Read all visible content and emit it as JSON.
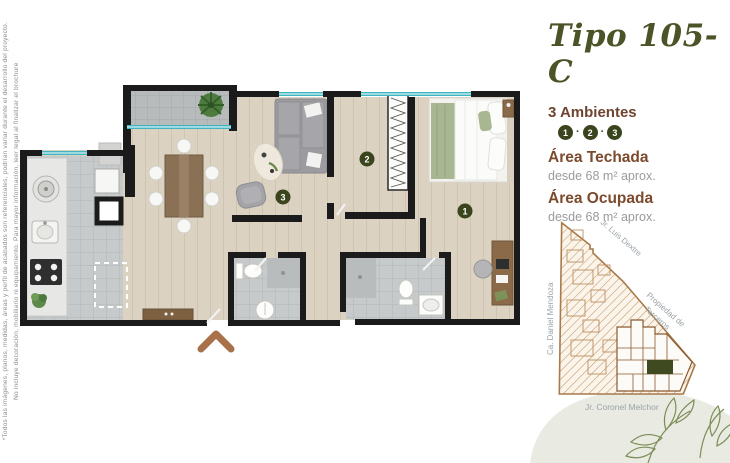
{
  "colors": {
    "title_green": "#4a5427",
    "ambientes_brown": "#6f4430",
    "area_brown": "#7c4a2d",
    "muted_gray": "#9b9b9b",
    "marker_olive": "#3b451d",
    "window_teal": "#3fb5c2",
    "map_brown": "#a87a4a",
    "unit_green": "#3f4a20",
    "chevron_brown": "#a9714a"
  },
  "disclaimer": {
    "line1": "*Todos las imágenes, planos, medidas, áreas y perfil de acabados son referenciales, podrían variar durante el desarrollo del proyecto.",
    "line2": "No incluye decoración, mobiliario ni equipamiento. Para mayor información, leer legal al finalizar el brochure"
  },
  "panel": {
    "title": "Tipo 105-C",
    "ambientes_label": "3 Ambientes",
    "separator": "·",
    "ambientes": [
      "1",
      "2",
      "3"
    ],
    "areas": [
      {
        "name": "Área Techada",
        "value": "desde 68 m² aprox."
      },
      {
        "name": "Área Ocupada",
        "value": "desde 68 m² aprox."
      }
    ]
  },
  "floor_plan": {
    "markers": {
      "bedroom": "1",
      "room2": "2",
      "living": "3"
    }
  },
  "site_map": {
    "street_top": "Jr. Luis Dextre",
    "street_left": "Ca. Daniel Mendoza",
    "street_right_line1": "Propiedad de",
    "street_right_line2": "Terceros",
    "street_bottom": "Jr. Coronel Melchor"
  }
}
